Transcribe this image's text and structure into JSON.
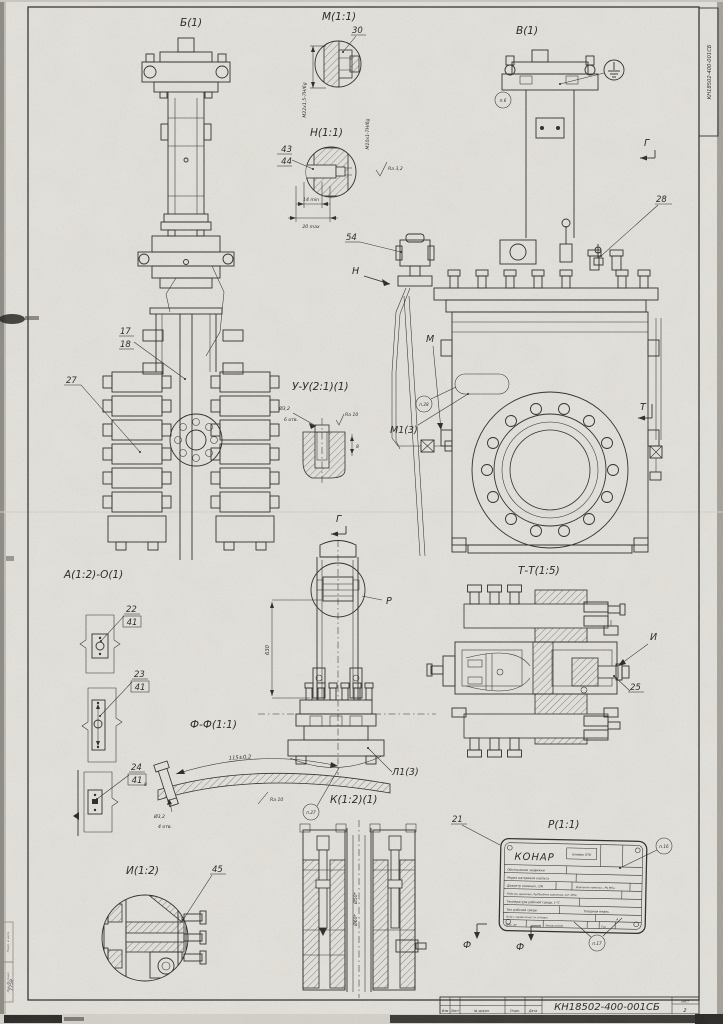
{
  "sheet": {
    "corner_number": "КН18502-400-001СБ",
    "title_number": "КН18502-400-001СБ",
    "sheet_label": "Лист",
    "sheet_value": "2",
    "copied": "Копировал",
    "format": "Формат",
    "cols": [
      "Изм",
      "Лист",
      "№ докум.",
      "Подп.",
      "Дата"
    ],
    "stamp_top": "Подп. и дата",
    "stamp_bottom": "Инв. № подл.",
    "stamp_handwritten": "7759"
  },
  "views": {
    "b": "Б(1)",
    "m_detail": "М(1:1)",
    "n_detail": "Н(1:1)",
    "v": "В(1)",
    "uu": "У-У(2:1)(1)",
    "a": "А(1:2)-О(1)",
    "tt": "Т-Т(1:5)",
    "ff": "Ф-Ф(1:1)",
    "i_detail": "И(1:2)",
    "k": "К(1:2)(1)",
    "plate": "Р(1:1)",
    "l1": "Л1(3)",
    "m1": "М1(3)"
  },
  "marks": {
    "g1": "Г",
    "g2": "Г",
    "p": "Р",
    "n": "Н",
    "m": "М",
    "i": "И",
    "t": "Т",
    "f1": "Ф",
    "f2": "Ф"
  },
  "callouts": {
    "c17": "17",
    "c18": "18",
    "c21": "21",
    "c22": "22",
    "c23": "23",
    "c24": "24",
    "c25": "25",
    "c27": "27",
    "c28": "28",
    "c30": "30",
    "c41": "41",
    "c43": "43",
    "c44": "44",
    "c45": "45",
    "c54": "54"
  },
  "refs": {
    "p6": "п.6",
    "p16": "п.16",
    "p17": "п.17",
    "p27": "п.27",
    "p28": "п.28"
  },
  "dims": {
    "thread_m22": "М22х1,5-7Н/6g",
    "thread_m10": "М10х1-7Н/6g",
    "ra32": "Ra 3,2",
    "min14": "14 min",
    "max20": "20 max",
    "d32_uu": "Ø3,2",
    "holes6": "6 отв.",
    "ra10_uu": "Ra 10",
    "depth8_uu": "8",
    "h630": "630",
    "len115": "115±0,2",
    "ra10_ff": "Ra 10",
    "d32_ff": "Ø3,2",
    "holes4": "4 отв.",
    "depth8_ff": "8",
    "d50": "Ø50*",
    "d60": "Ø60*"
  },
  "nameplate": {
    "brand": "КОНАР",
    "otk": "Клеймо ОТК",
    "rows": [
      "Обозначение задвижки",
      "Марка материала корпуса",
      "Диаметр номинал., DN",
      "Давление номинал., PN МПа",
      "Рабочее давление, Рр/Пробное давление, Δ Р, МПа",
      "Температура рабочей среды, t °C",
      "Тип рабочей среды",
      "Товарная нефть",
      "Класс герметичности затвора",
      "А",
      "Вес, кг",
      "Заводской №",
      "Год"
    ]
  }
}
